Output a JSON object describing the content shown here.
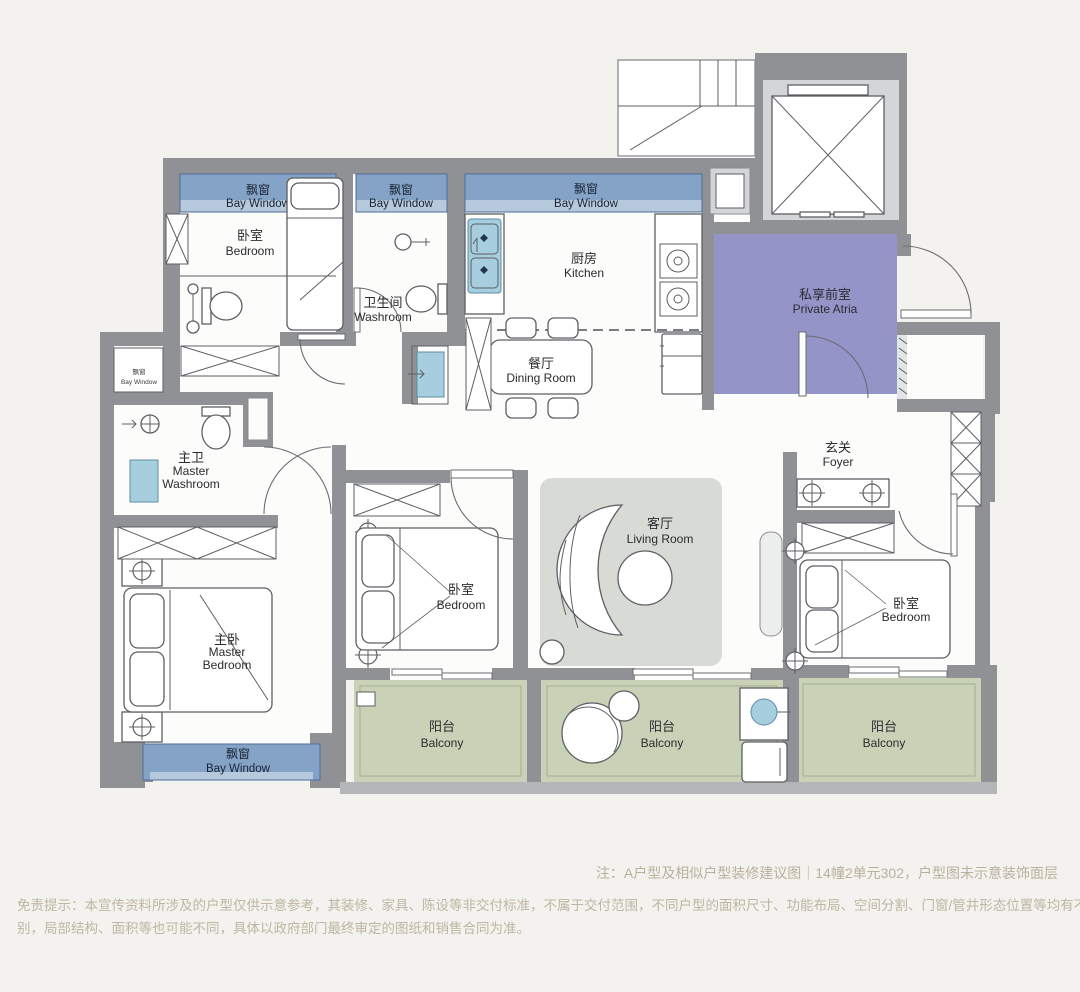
{
  "plan": {
    "rooms": {
      "bedroom_top_left": {
        "zh": "卧室",
        "en": "Bedroom"
      },
      "washroom": {
        "zh": "卫生间",
        "en": "Washroom"
      },
      "kitchen": {
        "zh": "厨房",
        "en": "Kitchen"
      },
      "dining_room": {
        "zh": "餐厅",
        "en": "Dining Room"
      },
      "private_atria": {
        "zh": "私享前室",
        "en": "Private Atria"
      },
      "foyer": {
        "zh": "玄关",
        "en": "Foyer"
      },
      "living_room": {
        "zh": "客厅",
        "en": "Living Room"
      },
      "master_washroom": {
        "zh": "主卫",
        "en_line1": "Master",
        "en_line2": "Washroom"
      },
      "master_bedroom": {
        "zh": "主卧",
        "en_line1": "Master",
        "en_line2": "Bedroom"
      },
      "bedroom_middle": {
        "zh": "卧室",
        "en": "Bedroom"
      },
      "bedroom_right": {
        "zh": "卧室",
        "en": "Bedroom"
      },
      "balcony_left": {
        "zh": "阳台",
        "en": "Balcony"
      },
      "balcony_center": {
        "zh": "阳台",
        "en": "Balcony"
      },
      "balcony_right": {
        "zh": "阳台",
        "en": "Balcony"
      }
    },
    "bay_windows": {
      "top_left": {
        "zh": "飘窗",
        "en": "Bay Window"
      },
      "top_middle": {
        "zh": "飘窗",
        "en": "Bay Window"
      },
      "kitchen": {
        "zh": "飘窗",
        "en": "Bay Window"
      },
      "left_small": {
        "zh": "飘窗",
        "en": "Bay Window"
      },
      "master_bottom": {
        "zh": "飘窗",
        "en": "Bay Window"
      }
    }
  },
  "footer": {
    "note": "注：A户型及相似户型装修建议图｜14幢2单元302，户型图未示意装饰面层",
    "disclaimer_line1": "免责提示：本宣传资料所涉及的户型仅供示意参考，其装修、家具、陈设等非交付标准，不属于交付范围，不同户型的面积尺寸、功能布局、空间分割、门窗/管井形态位置等均有不同；相同户型因楼栋、楼层、单元等差",
    "disclaimer_line2": "别，局部结构、面积等也可能不同，具体以政府部门最终审定的图纸和销售合同为准。"
  },
  "colors": {
    "background": "#f3f2ee",
    "wall": "#8f9195",
    "bay_window": "#84a3c7",
    "bay_window_light": "#b7c9dc",
    "private_atria": "#9494c9",
    "balcony": "#c9d2b7",
    "living_room": "#d8dbd5"
  }
}
